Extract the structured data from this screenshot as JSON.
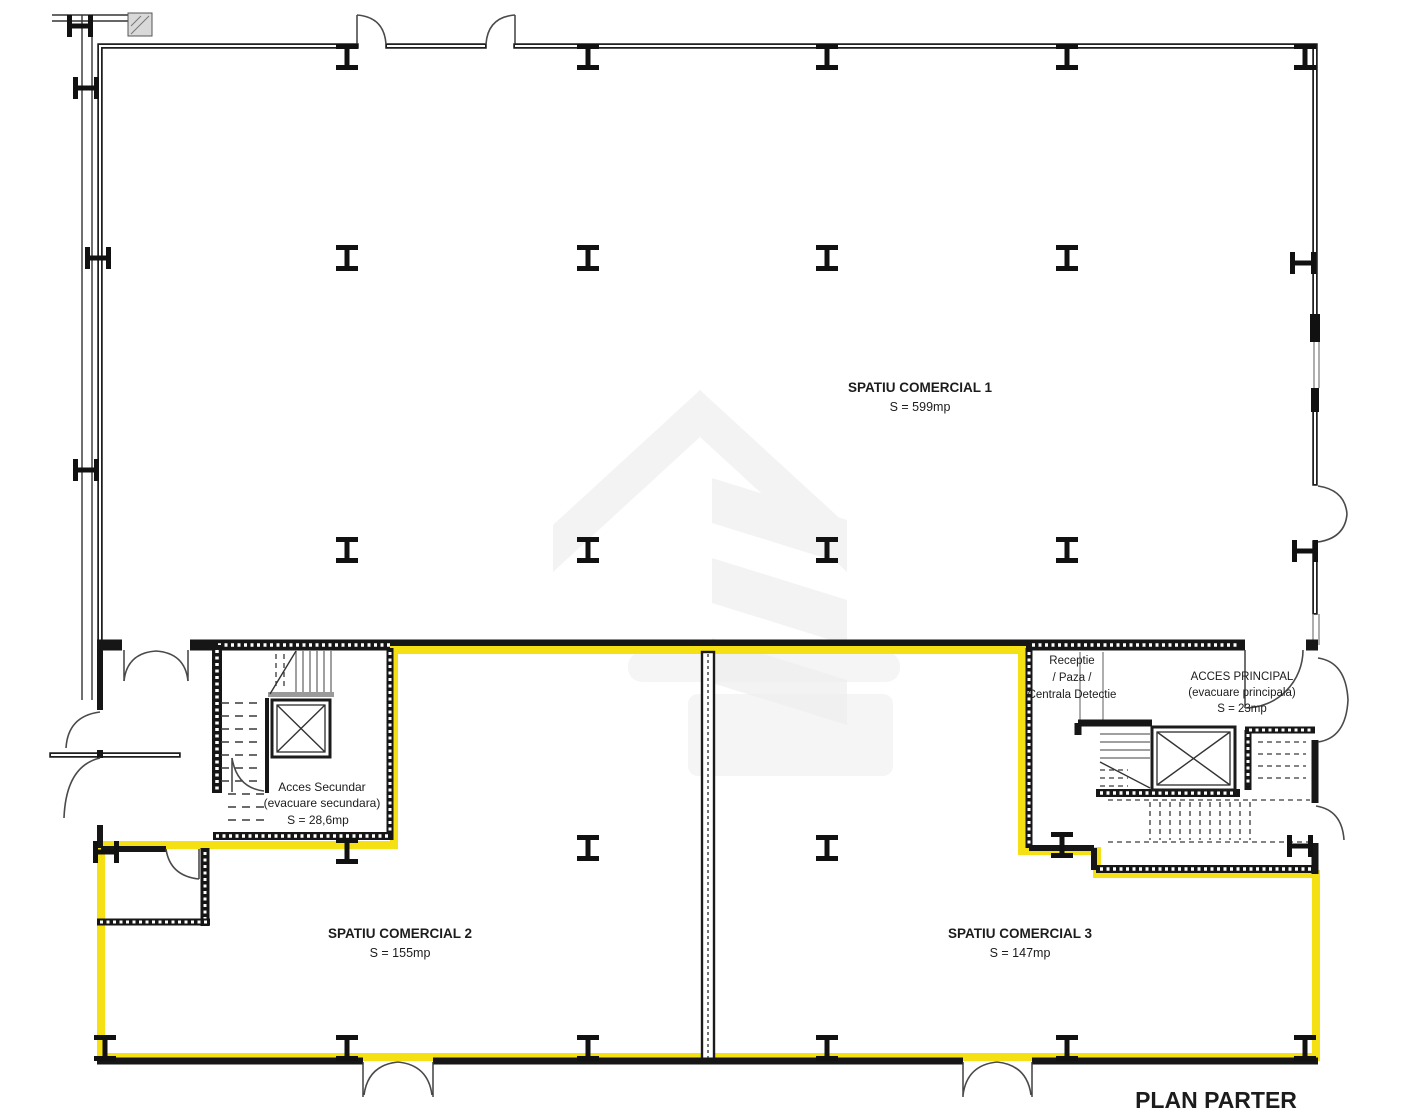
{
  "plan": {
    "title": "PLAN PARTER",
    "rooms": {
      "commercial1": {
        "name": "SPATIU COMERCIAL 1",
        "area": "S = 599mp"
      },
      "commercial2": {
        "name": "SPATIU COMERCIAL 2",
        "area": "S = 155mp"
      },
      "commercial3": {
        "name": "SPATIU COMERCIAL 3",
        "area": "S = 147mp"
      },
      "secondary_access": {
        "name": "Acces Secundar",
        "note": "(evacuare secundara)",
        "area": "S = 28,6mp"
      },
      "main_access": {
        "name": "ACCES PRINCIPAL",
        "note": "(evacuare principala)",
        "area": "S = 23mp"
      },
      "reception": {
        "line1": "Receptie",
        "line2": "/ Paza /",
        "line3": "Centrala Detectie"
      }
    },
    "colors": {
      "highlight": "#F5E013",
      "wall": "#1f1f1f",
      "watermark": "#f3f3f3"
    },
    "icons": {
      "column": "steel-column-icon",
      "elevator": "elevator-shaft-icon",
      "stairs": "stairs-icon",
      "door": "door-swing-icon",
      "watermark": "brand-watermark-icon"
    }
  }
}
